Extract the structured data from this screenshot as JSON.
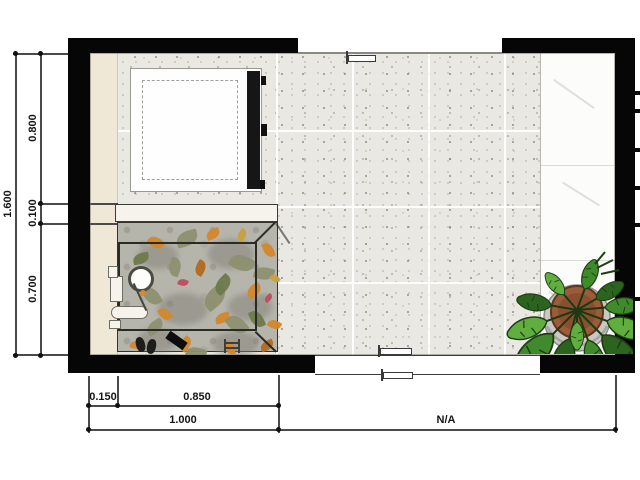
{
  "document": {
    "type": "floor-plan-drawing",
    "dimensions": {
      "left_total": "1.600",
      "left_top": "0.800",
      "left_mid": "0.100",
      "left_bottom": "0.700",
      "bottom_inset": "0.150",
      "bottom_span": "0.850",
      "bottom_total": "1.000",
      "bottom_right": "N/A"
    },
    "objects": [
      "washing-machine-icon",
      "leaf-rug-icon",
      "stroller-icon",
      "shoes-icon",
      "monstera-plant-icon",
      "marble-ledge-icon"
    ],
    "colors": {
      "wall": "#060606",
      "tile": "#e9e8e2",
      "beige": "#efe8d7",
      "step": "#f6f3ec",
      "rug_base": "#b6b5ac",
      "rug_border": "#2b2b26",
      "marble": "#fcfcfa",
      "pot": "#9a5c39",
      "plant_dark": "#2c641f",
      "plant_mid": "#3f8a2a",
      "plant_light": "#5fae3f",
      "leaf_orange": "#d4872c",
      "leaf_deep_orange": "#b06a20",
      "leaf_olive": "#8d9070",
      "leaf_moss": "#6e7a4c",
      "leaf_red": "#bf4d60",
      "leaf_mustard": "#c9a13c",
      "dimension_text": "#151515"
    },
    "rug_leaves": [
      {
        "x": 30,
        "y": 14,
        "w": 16,
        "h": 11,
        "r": 40,
        "c": "#d4872c"
      },
      {
        "x": 88,
        "y": 6,
        "w": 14,
        "h": 10,
        "r": -20,
        "c": "#d4872c"
      },
      {
        "x": 143,
        "y": 22,
        "w": 15,
        "h": 10,
        "r": 70,
        "c": "#d4872c"
      },
      {
        "x": 18,
        "y": 47,
        "w": 13,
        "h": 9,
        "r": 10,
        "c": "#d4872c"
      },
      {
        "x": 128,
        "y": 62,
        "w": 16,
        "h": 11,
        "r": -35,
        "c": "#d4872c"
      },
      {
        "x": 40,
        "y": 86,
        "w": 14,
        "h": 10,
        "r": 55,
        "c": "#d4872c"
      },
      {
        "x": 97,
        "y": 90,
        "w": 15,
        "h": 10,
        "r": -15,
        "c": "#d4872c"
      },
      {
        "x": 150,
        "y": 97,
        "w": 13,
        "h": 9,
        "r": 30,
        "c": "#d4872c"
      },
      {
        "x": 60,
        "y": 116,
        "w": 15,
        "h": 10,
        "r": -50,
        "c": "#d4872c"
      },
      {
        "x": 12,
        "y": 118,
        "w": 12,
        "h": 8,
        "r": 15,
        "c": "#d4872c"
      },
      {
        "x": 105,
        "y": 120,
        "w": 14,
        "h": 9,
        "r": 80,
        "c": "#d4872c"
      },
      {
        "x": 75,
        "y": 40,
        "w": 15,
        "h": 10,
        "r": -60,
        "c": "#b06a20"
      },
      {
        "x": 142,
        "y": 118,
        "w": 14,
        "h": 9,
        "r": -25,
        "c": "#b06a20"
      },
      {
        "x": 58,
        "y": 8,
        "w": 22,
        "h": 15,
        "r": -15,
        "c": "#8d9070"
      },
      {
        "x": 112,
        "y": 32,
        "w": 24,
        "h": 16,
        "r": 30,
        "c": "#8d9070"
      },
      {
        "x": 24,
        "y": 66,
        "w": 20,
        "h": 14,
        "r": 60,
        "c": "#8d9070"
      },
      {
        "x": 84,
        "y": 66,
        "w": 26,
        "h": 17,
        "r": -40,
        "c": "#8d9070"
      },
      {
        "x": 136,
        "y": 44,
        "w": 20,
        "h": 13,
        "r": 15,
        "c": "#8d9070"
      },
      {
        "x": 48,
        "y": 38,
        "w": 18,
        "h": 12,
        "r": -70,
        "c": "#8d9070"
      },
      {
        "x": 108,
        "y": 94,
        "w": 22,
        "h": 15,
        "r": 50,
        "c": "#8d9070"
      },
      {
        "x": 28,
        "y": 98,
        "w": 18,
        "h": 12,
        "r": -30,
        "c": "#8d9070"
      },
      {
        "x": 68,
        "y": 124,
        "w": 20,
        "h": 13,
        "r": 20,
        "c": "#8d9070"
      },
      {
        "x": 95,
        "y": 55,
        "w": 20,
        "h": 13,
        "r": -45,
        "c": "#6e7a4c"
      },
      {
        "x": 130,
        "y": 90,
        "w": 18,
        "h": 12,
        "r": 65,
        "c": "#6e7a4c"
      },
      {
        "x": 15,
        "y": 30,
        "w": 16,
        "h": 11,
        "r": -10,
        "c": "#6e7a4c"
      },
      {
        "x": 60,
        "y": 56,
        "w": 10,
        "h": 7,
        "r": 20,
        "c": "#bf4d60"
      },
      {
        "x": 146,
        "y": 72,
        "w": 9,
        "h": 6,
        "r": -40,
        "c": "#bf4d60"
      },
      {
        "x": 118,
        "y": 8,
        "w": 12,
        "h": 8,
        "r": -55,
        "c": "#c9a13c"
      },
      {
        "x": 152,
        "y": 52,
        "w": 10,
        "h": 7,
        "r": 45,
        "c": "#c9a13c"
      }
    ],
    "right_wall_ticks": [
      91,
      109,
      148,
      186,
      223,
      297
    ]
  }
}
